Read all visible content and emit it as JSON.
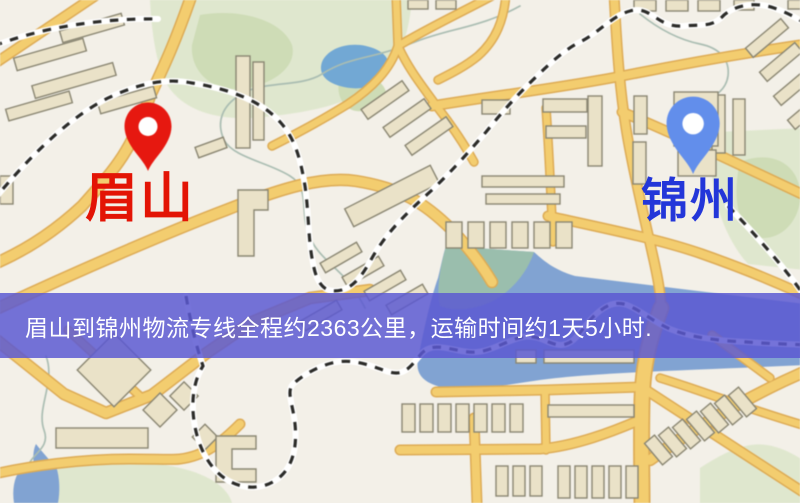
{
  "origin_marker": {
    "label": "眉山"
  },
  "destination_marker": {
    "label": "锦州"
  },
  "banner": {
    "text": "眉山到锦州物流专线全程约2363公里，运输时间约1天5小时."
  },
  "palette": {
    "background": "#f3f0e8",
    "road": "#f6cd68",
    "road_casing": "#e0ab4e",
    "building": "#ebe2c6",
    "building_outline": "#8a8671",
    "park": "#dfe7cc",
    "park_dark": "#cddcb4",
    "water": "#7fa3d6",
    "pond": "#6fa9d8",
    "stream": "#a9bdb2",
    "railway_base": "#ffffff",
    "railway_dash": "#2b2b28",
    "origin_pin": "#f2150c",
    "origin_label": "#e31405",
    "dest_pin": "#5f8ef2",
    "dest_label": "#2336d9",
    "banner_overlay": "rgba(91,88,210,0.84)",
    "banner_text": "#ffffff"
  }
}
